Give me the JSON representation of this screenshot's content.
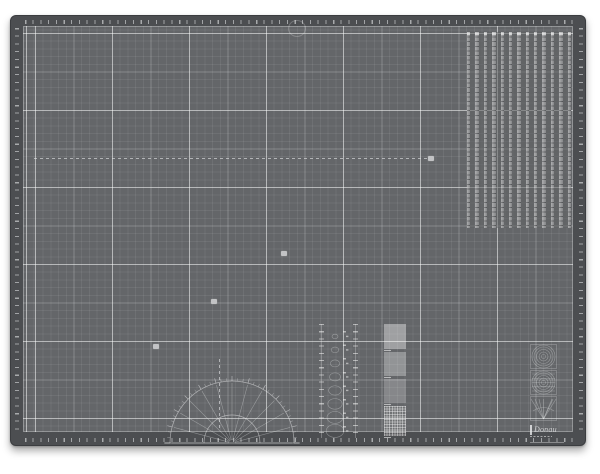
{
  "scene": {
    "description": "Gray self-healing cutting mat photographed on a white background",
    "object": "cutting-mat"
  },
  "colors": {
    "page_background": "#ffffff",
    "mat_border": "#4c4e51",
    "mat_rim": "#3b3d40",
    "field": "#646669",
    "grid_minor": "rgba(255,255,255,0.065)",
    "grid_medium": "rgba(255,255,255,0.17)",
    "grid_major": "rgba(255,255,255,0.40)",
    "edge_tick": "#a8aaac",
    "feature_line": "rgba(230,231,233,0.6)",
    "marker": "#c2c3c5"
  },
  "mat": {
    "x": 10,
    "y": 15,
    "width": 576,
    "height": 431,
    "corner_radius": 6
  },
  "grid": {
    "minor_period_px": 7.7,
    "medium_period_px": 38.5,
    "major_period_px": 77
  },
  "edge_ruler": {
    "minor_tick_px": 7.7,
    "major_tick_px": 38.5
  },
  "strip_panel": {
    "x": 466,
    "y": 31,
    "width": 104,
    "height": 196,
    "strip_count": 13
  },
  "protractor": {
    "cx": 231,
    "cy": 442,
    "outer_radius": 62,
    "inner_radius": 28,
    "line_step_deg": 15,
    "tick_step_deg": 5,
    "angle_range_deg": [
      0,
      180
    ]
  },
  "dashed_lines": [
    {
      "x1": 33,
      "y1": 157,
      "x2": 427,
      "y2": 157
    },
    {
      "x1": 218,
      "y1": 358,
      "x2": 218,
      "y2": 430
    }
  ],
  "markers": [
    {
      "x": 430,
      "y": 157
    },
    {
      "x": 283,
      "y": 252
    },
    {
      "x": 213,
      "y": 300
    },
    {
      "x": 155,
      "y": 345
    }
  ],
  "oval_template": {
    "x": 325,
    "y": 328,
    "width": 18,
    "height": 108,
    "count": 8
  },
  "micro_rulers": [
    {
      "x": 318,
      "y": 323,
      "height": 114
    },
    {
      "x": 352,
      "y": 323,
      "height": 114
    }
  ],
  "number_column": {
    "x": 342,
    "y": 330,
    "height": 104
  },
  "block_column": {
    "x": 383,
    "y": 323,
    "width": 22,
    "segments": [
      {
        "h": 25,
        "style": "plain-1"
      },
      {
        "h": 24,
        "style": "plain-2"
      },
      {
        "h": 24,
        "style": "plain-3"
      },
      {
        "h": 30,
        "style": "mesh"
      }
    ]
  },
  "shape_cells": {
    "x": 529,
    "y": 343,
    "cell_w": 27,
    "cell_h": 25,
    "types": [
      "concentric-circles",
      "lined-circles",
      "fan-lines"
    ]
  },
  "brand": {
    "logo_text": "Donau",
    "x": 529,
    "y": 424,
    "width": 34,
    "height": 17
  },
  "top_mark": {
    "x": 287,
    "y": 19,
    "width": 16,
    "height": 15
  }
}
